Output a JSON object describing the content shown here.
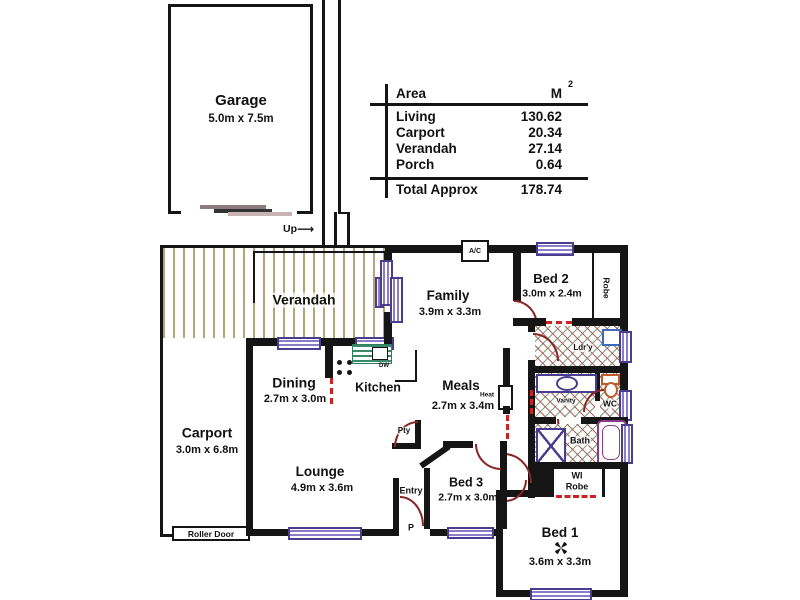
{
  "area_table": {
    "header": {
      "area": "Area",
      "unit": "M",
      "unit_sup": "2"
    },
    "rows": [
      {
        "label": "Living",
        "value": "130.62"
      },
      {
        "label": "Carport",
        "value": "20.34"
      },
      {
        "label": "Verandah",
        "value": "27.14"
      },
      {
        "label": "Porch",
        "value": "0.64"
      }
    ],
    "total_label": "Total Approx",
    "total_value": "178.74"
  },
  "rooms": {
    "garage": {
      "name": "Garage",
      "dims": "5.0m x 7.5m"
    },
    "verandah": {
      "name": "Verandah"
    },
    "carport": {
      "name": "Carport",
      "dims": "3.0m x 6.8m"
    },
    "family": {
      "name": "Family",
      "dims": "3.9m x 3.3m"
    },
    "bed2": {
      "name": "Bed 2",
      "dims": "3.0m x 2.4m"
    },
    "robe": {
      "name": "Robe"
    },
    "laundry": {
      "name": "Ldr'y"
    },
    "dining": {
      "name": "Dining",
      "dims": "2.7m x 3.0m"
    },
    "kitchen": {
      "name": "Kitchen"
    },
    "meals": {
      "name": "Meals",
      "dims": "2.7m x 3.4m"
    },
    "vanity": {
      "name": "Vanity"
    },
    "wc": {
      "name": "WC"
    },
    "bath": {
      "name": "Bath"
    },
    "wi_robe": {
      "line1": "WI",
      "line2": "Robe"
    },
    "lounge": {
      "name": "Lounge",
      "dims": "4.9m x 3.6m"
    },
    "bed3": {
      "name": "Bed 3",
      "dims": "2.7m x 3.0m"
    },
    "bed1": {
      "name": "Bed 1",
      "dims": "3.6m x 3.3m"
    },
    "entry": {
      "name": "Entry"
    },
    "porch": {
      "name": "P"
    },
    "pantry": {
      "name": "Pty"
    }
  },
  "annotations": {
    "up": "Up",
    "ac": "A/C",
    "dw": "DW",
    "heat": "Heat",
    "roller_door": "Roller Door"
  },
  "colors": {
    "wall": "#151515",
    "window_frame": "#4a3d8f",
    "door_arc": "#8b2525",
    "verandah_stripe": "#a9a97b",
    "tile_red": "#b05050",
    "tile_green": "#6a9a6a",
    "fixture_purple": "#8b3a8b",
    "toilet_orange": "#c05a2a"
  }
}
